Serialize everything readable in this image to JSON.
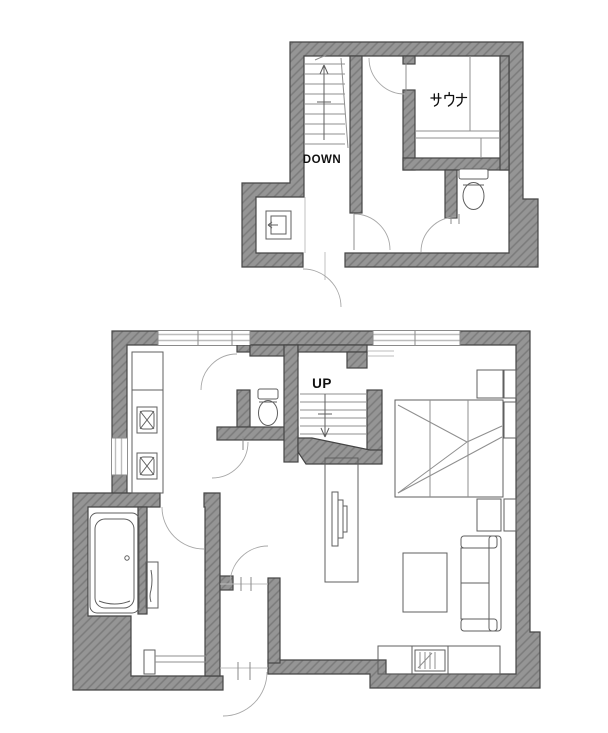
{
  "diagram": {
    "type": "architectural-floor-plan",
    "floors": [
      {
        "name": "second-floor",
        "stair_label": "DOWN",
        "rooms": [
          {
            "name": "sauna",
            "label": "サウナ"
          },
          {
            "name": "toilet"
          },
          {
            "name": "stair-hall"
          },
          {
            "name": "free-room"
          }
        ]
      },
      {
        "name": "first-floor",
        "stair_label": "UP",
        "rooms": [
          {
            "name": "kitchen"
          },
          {
            "name": "toilet"
          },
          {
            "name": "bathroom"
          },
          {
            "name": "washroom"
          },
          {
            "name": "entry"
          },
          {
            "name": "living-bedroom"
          }
        ]
      }
    ],
    "colors": {
      "wall_fill": "#959595",
      "wall_hatch": "#7b7b7b",
      "wall_outline": "#454545",
      "line": "#8f8f8f",
      "line_dark": "#5f5f5f",
      "window": "#bdbdbd",
      "label_text": "#111111"
    }
  }
}
